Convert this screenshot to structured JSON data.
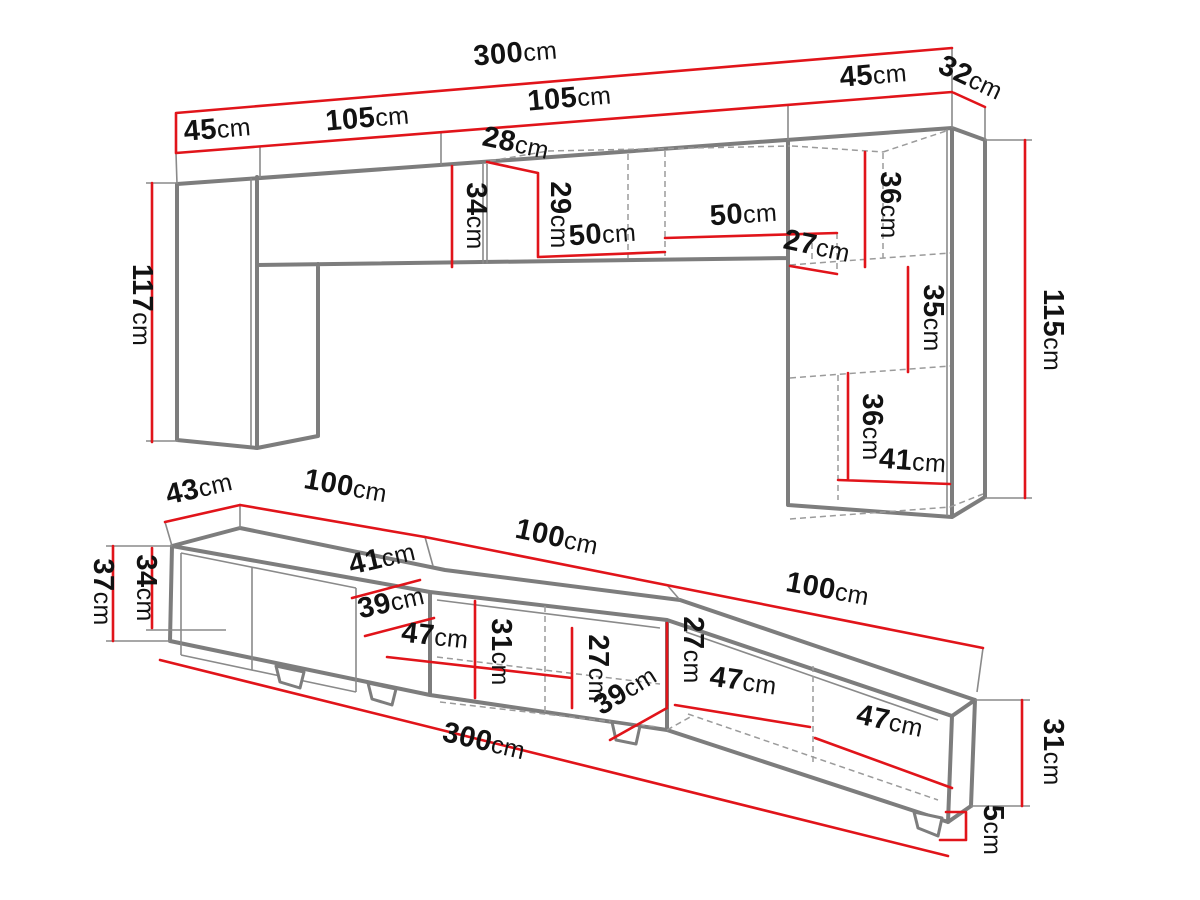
{
  "diagram": {
    "units": "cm",
    "colors": {
      "dimension_red": "#e1141a",
      "edge_gray": "#7d7d7d",
      "text": "#121212",
      "background": "#ffffff"
    },
    "wall_unit": {
      "total_width": {
        "v": "300",
        "u": "cm"
      },
      "left_width": {
        "v": "45",
        "u": "cm"
      },
      "cabinet_a_width": {
        "v": "105",
        "u": "cm"
      },
      "cabinet_b_width": {
        "v": "105",
        "u": "cm"
      },
      "right_width": {
        "v": "45",
        "u": "cm"
      },
      "right_depth": {
        "v": "32",
        "u": "cm"
      },
      "niche_depth": {
        "v": "28",
        "u": "cm"
      },
      "door_height": {
        "v": "34",
        "u": "cm"
      },
      "niche_height": {
        "v": "29",
        "u": "cm"
      },
      "shelf_a_width": {
        "v": "50",
        "u": "cm"
      },
      "shelf_b_width": {
        "v": "50",
        "u": "cm"
      },
      "niche_b_depth": {
        "v": "27",
        "u": "cm"
      },
      "shelf_top_height": {
        "v": "36",
        "u": "cm"
      },
      "shelf_mid_height": {
        "v": "35",
        "u": "cm"
      },
      "shelf_bot_height": {
        "v": "36",
        "u": "cm"
      },
      "bottom_width": {
        "v": "41",
        "u": "cm"
      },
      "left_height": {
        "v": "117",
        "u": "cm"
      },
      "right_height": {
        "v": "115",
        "u": "cm"
      }
    },
    "tv_stand": {
      "depth": {
        "v": "43",
        "u": "cm"
      },
      "section_a_width": {
        "v": "100",
        "u": "cm"
      },
      "section_b_width": {
        "v": "100",
        "u": "cm"
      },
      "section_c_width": {
        "v": "100",
        "u": "cm"
      },
      "total_height": {
        "v": "37",
        "u": "cm"
      },
      "body_height": {
        "v": "34",
        "u": "cm"
      },
      "top_depth": {
        "v": "41",
        "u": "cm"
      },
      "shelf_a_depth": {
        "v": "39",
        "u": "cm"
      },
      "shelf_a_width": {
        "v": "47",
        "u": "cm"
      },
      "niche_a_height": {
        "v": "31",
        "u": "cm"
      },
      "niche_b_height": {
        "v": "27",
        "u": "cm"
      },
      "niche_c_height": {
        "v": "27",
        "u": "cm"
      },
      "shelf_b_depth": {
        "v": "39",
        "u": "cm"
      },
      "shelf_b_width": {
        "v": "47",
        "u": "cm"
      },
      "shelf_c_width": {
        "v": "47",
        "u": "cm"
      },
      "end_height": {
        "v": "31",
        "u": "cm"
      },
      "total_width": {
        "v": "300",
        "u": "cm"
      },
      "foot_height": {
        "v": "5",
        "u": "cm"
      }
    }
  }
}
